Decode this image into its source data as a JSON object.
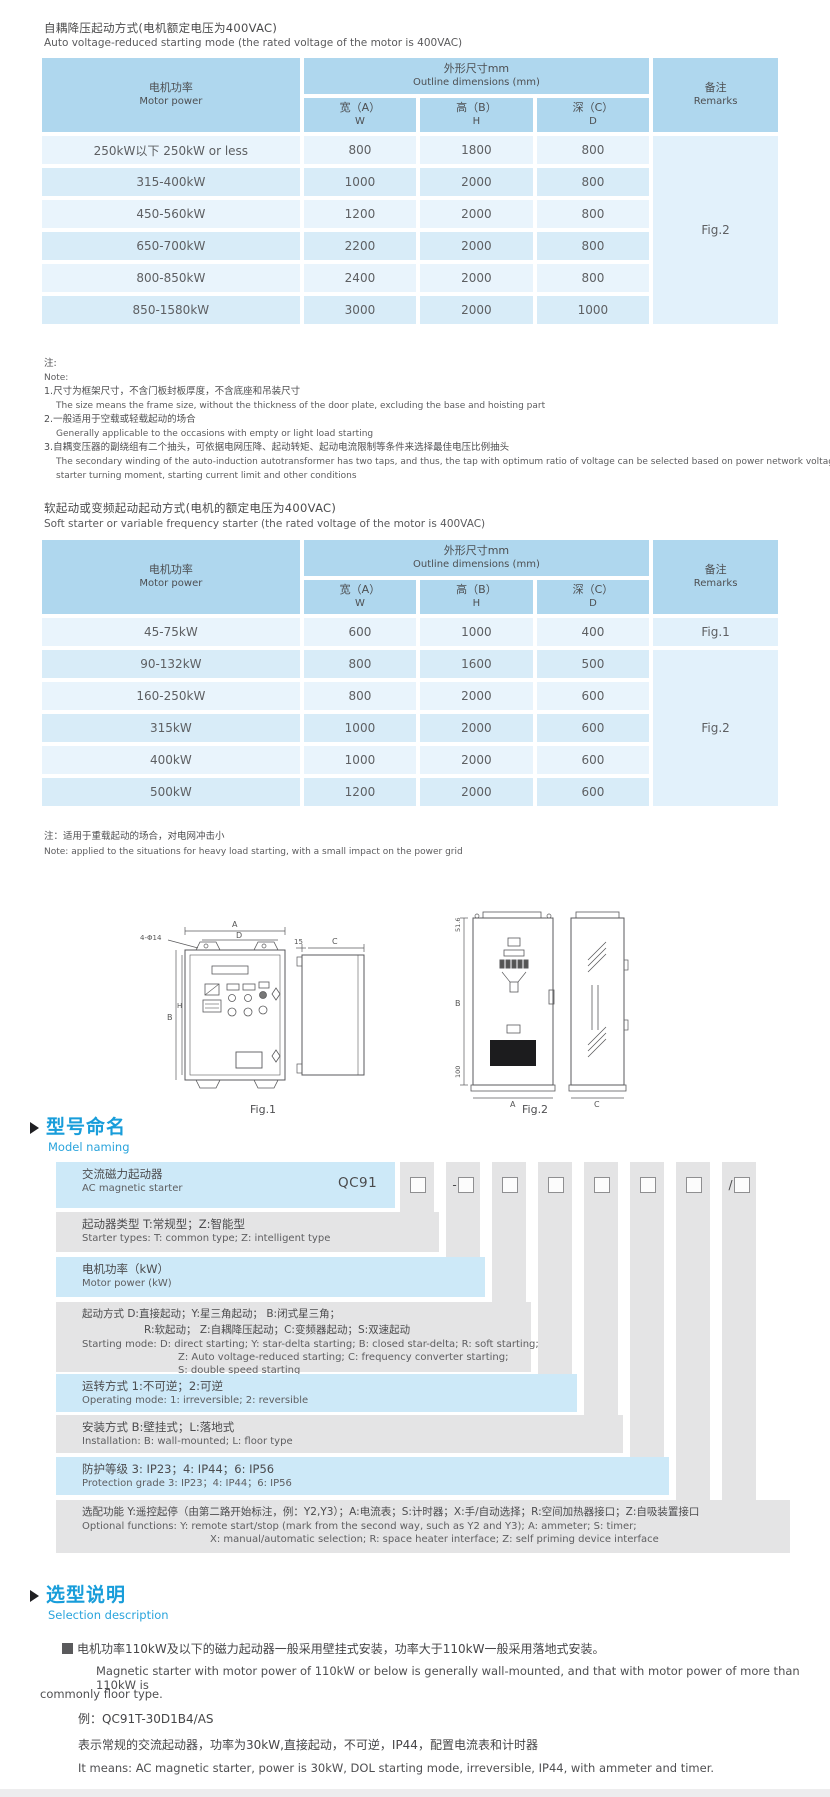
{
  "auto": {
    "title_zh": "自耦降压起动方式(电机额定电压为400VAC)",
    "title_en": "Auto voltage-reduced starting mode (the rated voltage of the motor is 400VAC)",
    "header": {
      "motor_zh": "电机功率",
      "motor_en": "Motor power",
      "outline_zh": "外形尺寸mm",
      "outline_en": "Outline dimensions (mm)",
      "w_zh": "宽（A）",
      "w_sub": "W",
      "h_zh": "高（B）",
      "h_sub": "H",
      "d_zh": "深（C）",
      "d_sub": "D",
      "remarks_zh": "备注",
      "remarks_en": "Remarks"
    },
    "rows": [
      {
        "power": "250kW以下 250kW or less",
        "w": "800",
        "h": "1800",
        "d": "800"
      },
      {
        "power": "315-400kW",
        "w": "1000",
        "h": "2000",
        "d": "800"
      },
      {
        "power": "450-560kW",
        "w": "1200",
        "h": "2000",
        "d": "800"
      },
      {
        "power": "650-700kW",
        "w": "2200",
        "h": "2000",
        "d": "800"
      },
      {
        "power": "800-850kW",
        "w": "2400",
        "h": "2000",
        "d": "800"
      },
      {
        "power": "850-1580kW",
        "w": "3000",
        "h": "2000",
        "d": "1000"
      }
    ],
    "remark": "Fig.2",
    "notes": {
      "label_zh": "注:",
      "label_en": "Note:",
      "n1_zh": "1.尺寸为框架尺寸，不含门板封板厚度，不含底座和吊装尺寸",
      "n1_en": "The size means the frame size, without the thickness of the door plate, excluding the base and hoisting part",
      "n2_zh": "2.一般适用于空载或轻载起动的场合",
      "n2_en": "Generally applicable to the occasions with empty or light load starting",
      "n3_zh": "3.自耦变压器的副绕组有二个抽头，可依据电网压降、起动转矩、起动电流限制等条件来选择最佳电压比例抽头",
      "n3_en1": "The secondary winding of the auto-induction autotransformer has two taps, and thus, the tap with optimum ratio of voltage can be selected based on power network voltage drop,",
      "n3_en2": "starter turning moment, starting current limit and other conditions"
    }
  },
  "soft": {
    "title_zh": "软起动或变频起动起动方式(电机的额定电压为400VAC)",
    "title_en": "Soft starter or variable frequency starter (the rated voltage of the motor is 400VAC)",
    "header": {
      "motor_zh": "电机功率",
      "motor_en": "Motor power",
      "outline_zh": "外形尺寸mm",
      "outline_en": "Outline dimensions (mm)",
      "w_zh": "宽（A）",
      "w_sub": "W",
      "h_zh": "高（B）",
      "h_sub": "H",
      "d_zh": "深（C）",
      "d_sub": "D",
      "remarks_zh": "备注",
      "remarks_en": "Remarks"
    },
    "rows": [
      {
        "power": "45-75kW",
        "w": "600",
        "h": "1000",
        "d": "400",
        "remark": "Fig.1"
      },
      {
        "power": "90-132kW",
        "w": "800",
        "h": "1600",
        "d": "500"
      },
      {
        "power": "160-250kW",
        "w": "800",
        "h": "2000",
        "d": "600"
      },
      {
        "power": "315kW",
        "w": "1000",
        "h": "2000",
        "d": "600"
      },
      {
        "power": "400kW",
        "w": "1000",
        "h": "2000",
        "d": "600"
      },
      {
        "power": "500kW",
        "w": "1200",
        "h": "2000",
        "d": "600"
      }
    ],
    "remark2": "Fig.2",
    "note_zh": "注：适用于重载起动的场合，对电网冲击小",
    "note_en": "Note: applied to the situations for heavy load starting, with a small impact on the power grid"
  },
  "figures": {
    "fig1": {
      "caption": "Fig.1",
      "dims": {
        "a": "A",
        "d": "D",
        "holes": "4-Φ14",
        "b": "B",
        "h": "H",
        "t15": "15",
        "c": "C"
      }
    },
    "fig2": {
      "caption": "Fig.2",
      "dims": {
        "top": "51.6",
        "b": "B",
        "bottom": "100",
        "a": "A",
        "c": "C"
      }
    }
  },
  "model": {
    "heading_zh": "型号命名",
    "heading_en": "Model naming",
    "code": "QC91",
    "code_columns": [
      {
        "prefix": ""
      },
      {
        "prefix": "-"
      },
      {
        "prefix": ""
      },
      {
        "prefix": ""
      },
      {
        "prefix": ""
      },
      {
        "prefix": ""
      },
      {
        "prefix": ""
      },
      {
        "prefix": "/"
      }
    ],
    "rows": {
      "r1": {
        "zh": "交流磁力起动器",
        "en": "AC magnetic starter"
      },
      "r2": {
        "zh": "起动器类型 T:常规型；Z:智能型",
        "en": "Starter types: T: common type; Z: intelligent type"
      },
      "r3": {
        "zh": "电机功率（kW）",
        "en": "Motor power (kW)"
      },
      "r4": {
        "zh1": "起动方式  D:直接起动；Y:星三角起动；   B:闭式星三角；",
        "zh2": "R:软起动；   Z:自耦降压起动；C:变频器起动；S:双速起动",
        "en1": "Starting mode: D: direct starting; Y: star-delta starting; B: closed star-delta; R: soft starting;",
        "en2": "Z: Auto voltage-reduced starting; C: frequency converter starting;",
        "en3": "S: double speed starting"
      },
      "r5": {
        "zh": "运转方式 1:不可逆；2:可逆",
        "en": "Operating mode: 1: irreversible; 2: reversible"
      },
      "r6": {
        "zh": "安装方式 B:壁挂式；L:落地式",
        "en": "Installation: B: wall-mounted;  L: floor type"
      },
      "r7": {
        "zh": "防护等级  3: IP23；4: IP44；6: IP56",
        "en": "Protection grade  3: IP23；4: IP44；6: IP56"
      },
      "r8": {
        "zh": "选配功能  Y:遥控起停（由第二路开始标注，例：Y2,Y3）；A:电流表；S:计时器；X:手/自动选择；R:空间加热器接口；Z:自吸装置接口",
        "en1": "Optional functions: Y: remote start/stop (mark from the second way, such as Y2 and Y3); A: ammeter; S: timer;",
        "en2": "X: manual/automatic selection; R: space heater interface; Z: self priming device interface"
      }
    }
  },
  "selection": {
    "heading_zh": "选型说明",
    "heading_en": "Selection description",
    "p1_zh": "电机功率110kW及以下的磁力起动器一般采用壁挂式安装，功率大于110kW一般采用落地式安装。",
    "p1_en1": "Magnetic starter with motor power of 110kW or below is generally wall-mounted, and that with motor power of more than 110kW is",
    "p1_en2": "commonly floor type.",
    "example": "例：QC91T-30D1B4/AS",
    "desc_zh": "表示常规的交流起动器，功率为30kW,直接起动，不可逆，IP44，配置电流表和计时器",
    "desc_en": "It means: AC magnetic starter, power is 30kW, DOL starting mode, irreversible, IP44, with ammeter and timer."
  }
}
